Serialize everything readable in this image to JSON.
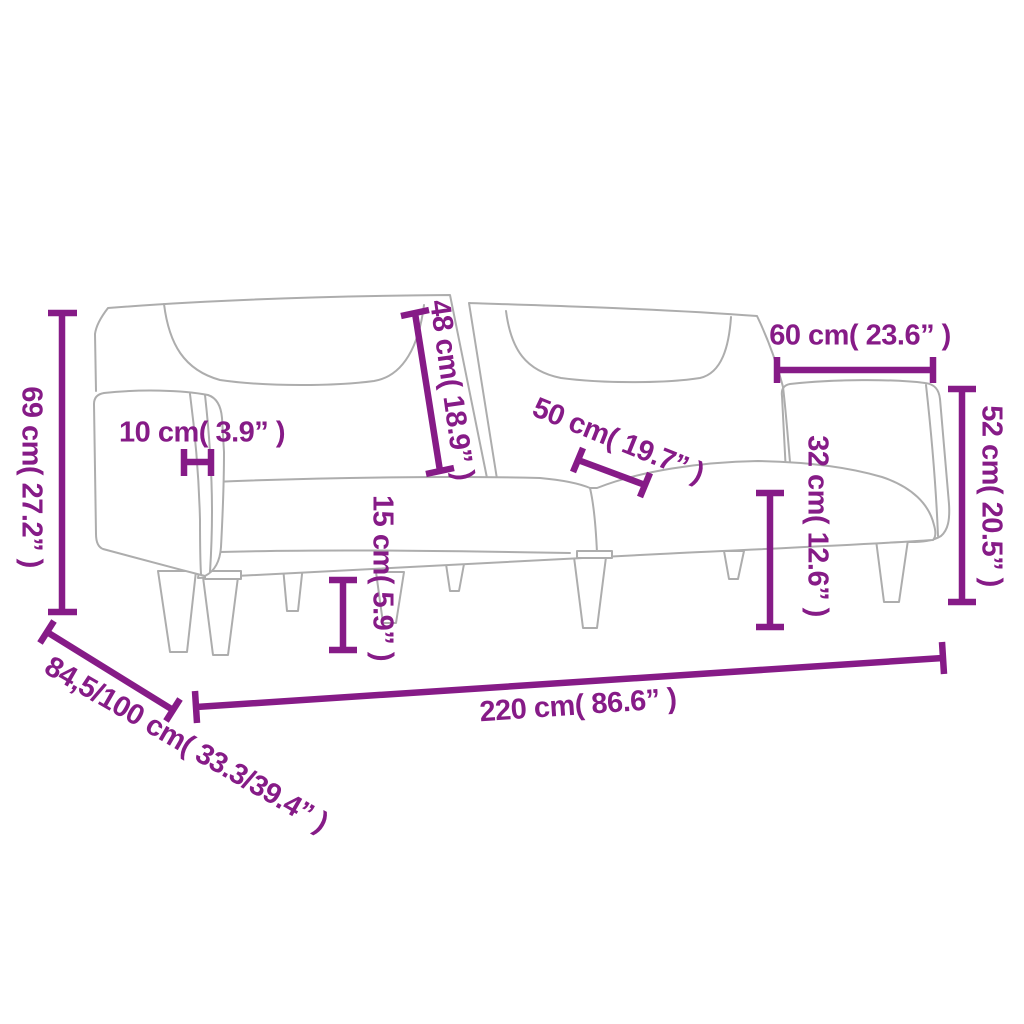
{
  "diagram": {
    "subject": "two-seater sofa bed dimension line drawing",
    "dimension_color": "#861b87",
    "outline_color": "#adadad",
    "background_color": "#ffffff",
    "unit_system": "cm with inches in parentheses"
  },
  "dims": {
    "overall_height": {
      "label": "69 cm( 27.2” )",
      "value_cm": "69",
      "value_in": "27.2"
    },
    "armrest_width": {
      "label": "10 cm( 3.9” )",
      "value_cm": "10",
      "value_in": "3.9"
    },
    "backrest_height": {
      "label": "48 cm( 18.9” )",
      "value_cm": "48",
      "value_in": "18.9"
    },
    "seat_depth": {
      "label": "50 cm( 19.7” )",
      "value_cm": "50",
      "value_in": "19.7"
    },
    "right_armrest_length": {
      "label": "60 cm( 23.6” )",
      "value_cm": "60",
      "value_in": "23.6"
    },
    "right_armrest_height": {
      "label": "52 cm( 20.5” )",
      "value_cm": "52",
      "value_in": "20.5"
    },
    "seat_height": {
      "label": "32 cm( 12.6” )",
      "value_cm": "32",
      "value_in": "12.6"
    },
    "leg_height": {
      "label": "15 cm( 5.9” )",
      "value_cm": "15",
      "value_in": "5.9"
    },
    "overall_width": {
      "label": "220 cm( 86.6” )",
      "value_cm": "220",
      "value_in": "86.6"
    },
    "overall_depth": {
      "label": "84,5/100 cm( 33.3/39.4” )",
      "value_cm": "84,5/100",
      "value_in": "33.3/39.4"
    }
  }
}
